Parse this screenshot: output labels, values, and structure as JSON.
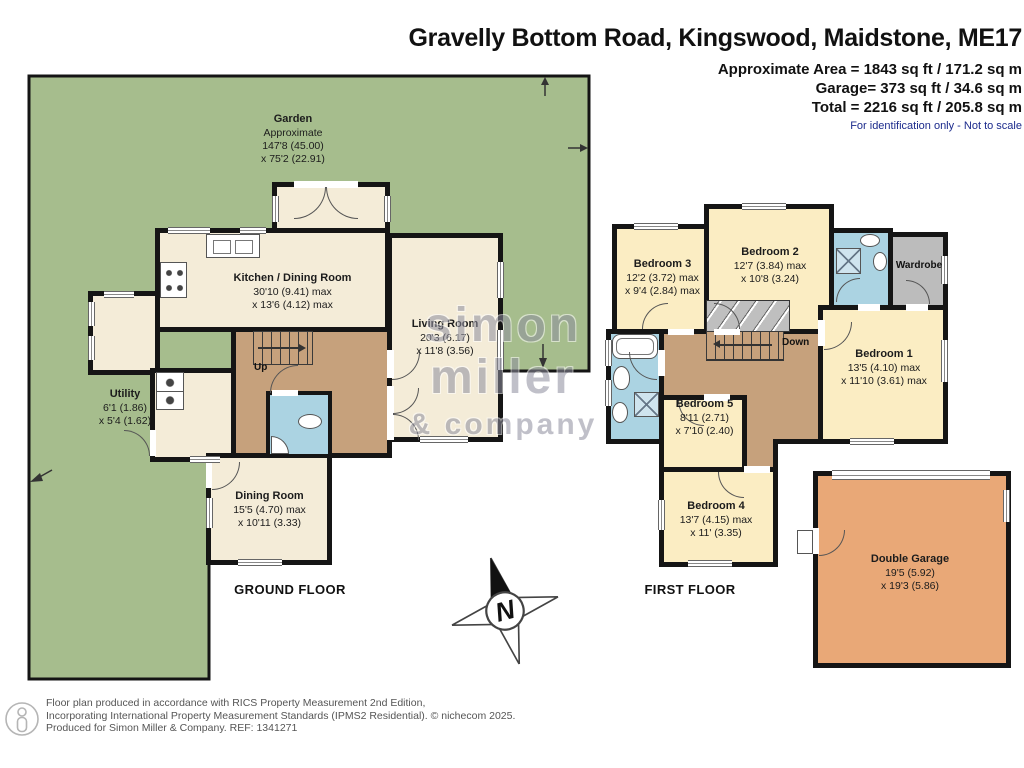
{
  "header": {
    "title": "Gravelly Bottom Road, Kingswood, Maidstone, ME17",
    "area_line": "Approximate Area = 1843 sq ft / 171.2 sq m",
    "garage_line": "Garage= 373 sq ft / 34.6 sq m",
    "total_line": "Total = 2216 sq ft / 205.8 sq m",
    "disclaimer": "For identification only - Not to scale"
  },
  "garden": {
    "name": "Garden",
    "approx": "Approximate",
    "dim1": "147'8 (45.00)",
    "dim2": "x 75'2 (22.91)"
  },
  "ground_floor": {
    "label": "GROUND FLOOR",
    "stairs_label": "Up",
    "rooms": [
      {
        "name": "Kitchen / Dining Room",
        "dim1": "30'10 (9.41) max",
        "dim2": "x 13'6 (4.12) max"
      },
      {
        "name": "Living Room",
        "dim1": "20'3 (6.17)",
        "dim2": "x 11'8 (3.56)"
      },
      {
        "name": "Utility",
        "dim1": "6'1 (1.86)",
        "dim2": "x 5'4 (1.62)"
      },
      {
        "name": "Dining Room",
        "dim1": "15'5 (4.70) max",
        "dim2": "x 10'11 (3.33)"
      }
    ]
  },
  "first_floor": {
    "label": "FIRST FLOOR",
    "stairs_label": "Down",
    "wardrobe_label": "Wardrobe",
    "rooms": [
      {
        "name": "Bedroom 3",
        "dim1": "12'2 (3.72) max",
        "dim2": "x 9'4 (2.84) max"
      },
      {
        "name": "Bedroom 2",
        "dim1": "12'7 (3.84) max",
        "dim2": "x 10'8 (3.24)"
      },
      {
        "name": "Bedroom 1",
        "dim1": "13'5 (4.10) max",
        "dim2": "x 11'10 (3.61) max"
      },
      {
        "name": "Bedroom 5",
        "dim1": "8'11 (2.71)",
        "dim2": "x 7'10 (2.40)"
      },
      {
        "name": "Bedroom 4",
        "dim1": "13'7 (4.15) max",
        "dim2": "x 11' (3.35)"
      }
    ]
  },
  "garage": {
    "name": "Double Garage",
    "dim1": "19'5 (5.92)",
    "dim2": "x 19'3 (5.86)"
  },
  "compass": {
    "label": "N"
  },
  "watermark": {
    "line1": "simon",
    "line2": "miller",
    "line3": "& company"
  },
  "footer": {
    "line1": "Floor plan produced in accordance with RICS Property Measurement 2nd Edition,",
    "line2": "Incorporating International Property Measurement Standards (IPMS2 Residential).  © nichecom 2025.",
    "line3": "Produced for Simon Miller & Company.   REF: 1341271"
  },
  "colors": {
    "garden_green": "#a6bd8d",
    "room_cream": "#f4ecd8",
    "bedroom_yellow": "#fbedc3",
    "hallway_tan": "#c6a17c",
    "bathroom_blue": "#abd3e2",
    "wardrobe_gray": "#bcbcbc",
    "garage_orange": "#e9a877",
    "wall_black": "#151515",
    "disclaimer_blue": "#1b2a8c"
  }
}
